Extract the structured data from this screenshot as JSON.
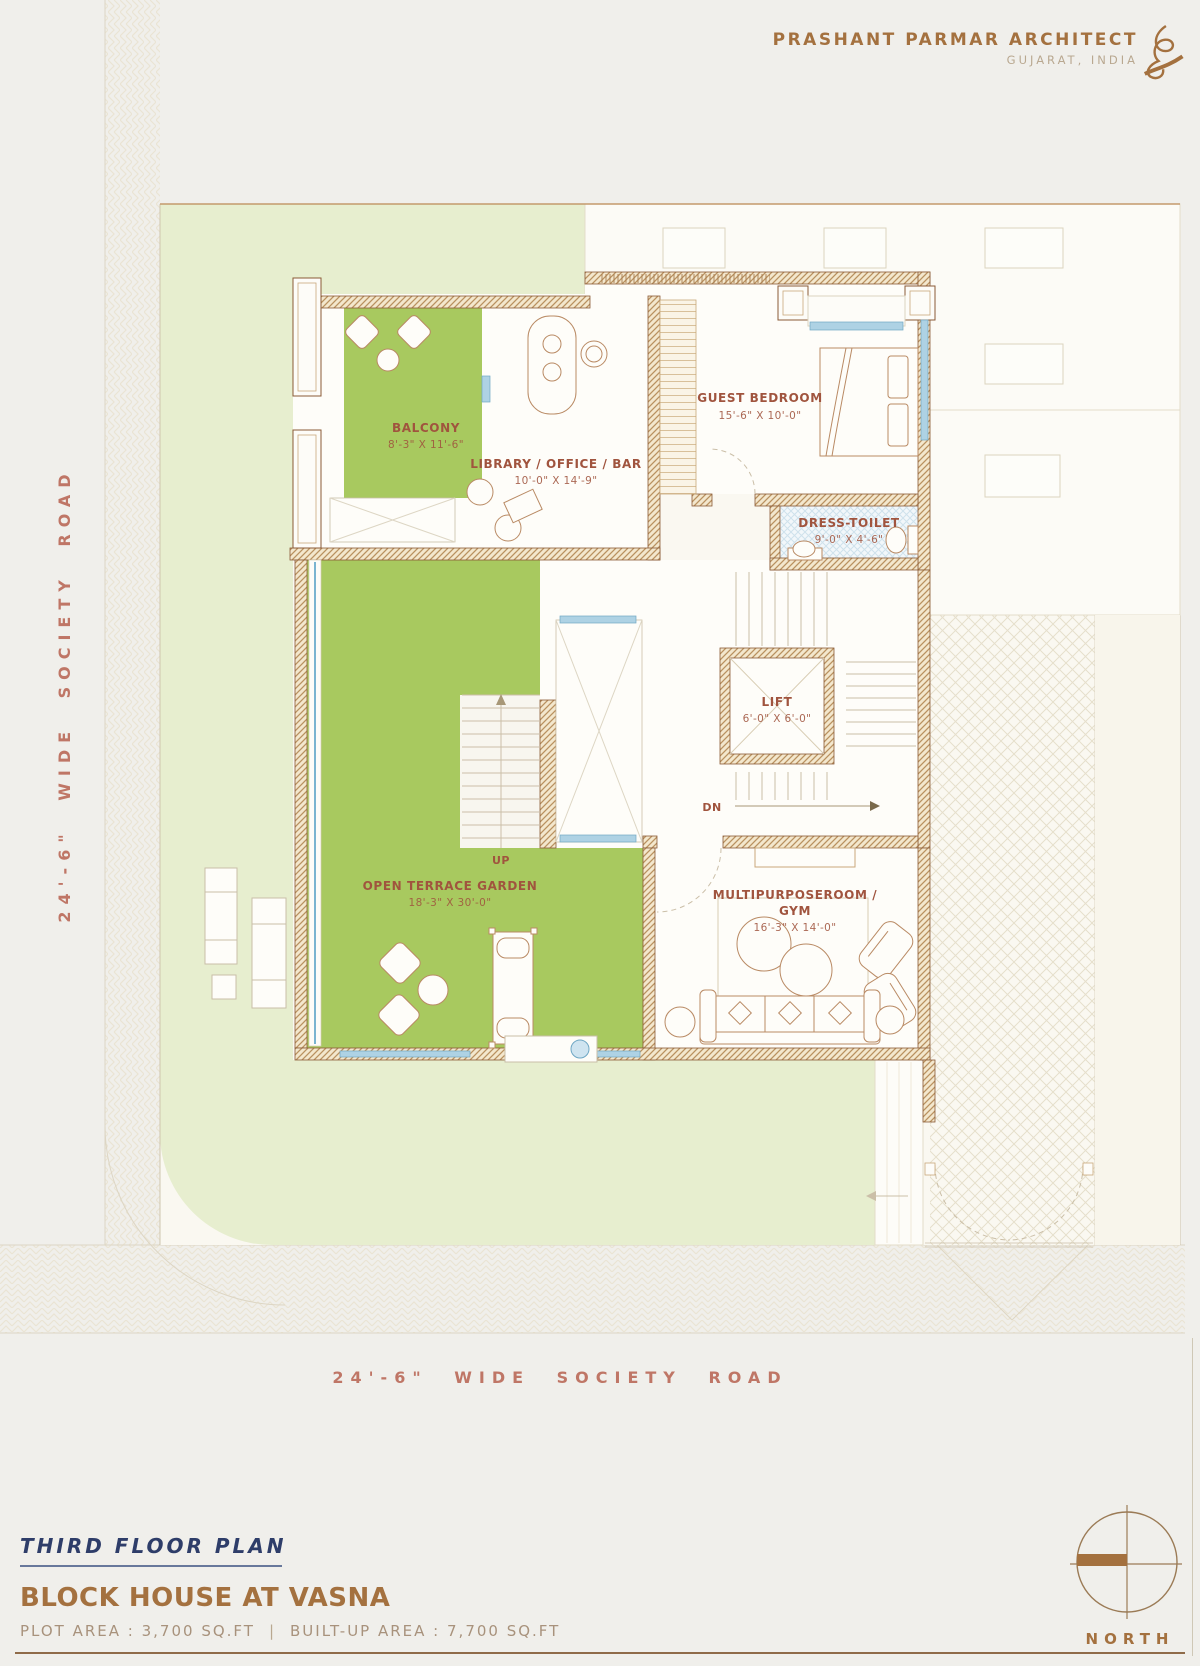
{
  "header": {
    "firm": "PRASHANT PARMAR ARCHITECT",
    "location": "GUJARAT, INDIA"
  },
  "roads": {
    "left": "24'-6\" WIDE SOCIETY ROAD",
    "bottom": "24'-6\" WIDE SOCIETY ROAD"
  },
  "plan": {
    "rooms": {
      "balcony": {
        "name": "BALCONY",
        "dims": "8'-3\" X 11'-6\""
      },
      "library": {
        "name": "LIBRARY / OFFICE / BAR",
        "dims": "10'-0\" X 14'-9\""
      },
      "guest_bedroom": {
        "name": "GUEST BEDROOM",
        "dims": "15'-6\" X 10'-0\""
      },
      "dress_toilet": {
        "name": "DRESS-TOILET",
        "dims": "9'-0\" X 4'-6\""
      },
      "lift": {
        "name": "LIFT",
        "dims": "6'-0\" X 6'-0\""
      },
      "terrace": {
        "name": "OPEN TERRACE GARDEN",
        "dims": "18'-3\" X 30'-0\""
      },
      "gym": {
        "name_line1": "MULTIPURPOSEROOM /",
        "name_line2": "GYM",
        "dims": "16'-3\" X 14'-0\""
      }
    },
    "stairs": {
      "up": "UP",
      "down": "DN"
    }
  },
  "footer": {
    "plan_title": "THIRD FLOOR PLAN",
    "project_title": "BLOCK HOUSE AT VASNA",
    "plot_area": "PLOT AREA : 3,700 SQ.FT",
    "separator": "|",
    "built_up_area": "BUILT-UP AREA : 7,700 SQ.FT"
  },
  "compass": {
    "label": "NORTH"
  },
  "colors": {
    "accent_brown": "#a4713f",
    "label_red_brown": "#a0543e",
    "road_text": "#bf7666",
    "navy": "#2e3d69",
    "terrace_green": "#a8c95f",
    "lawn_green": "#e7eecf",
    "wall_brown": "#8a5a36",
    "window_blue": "#aed2e4"
  }
}
